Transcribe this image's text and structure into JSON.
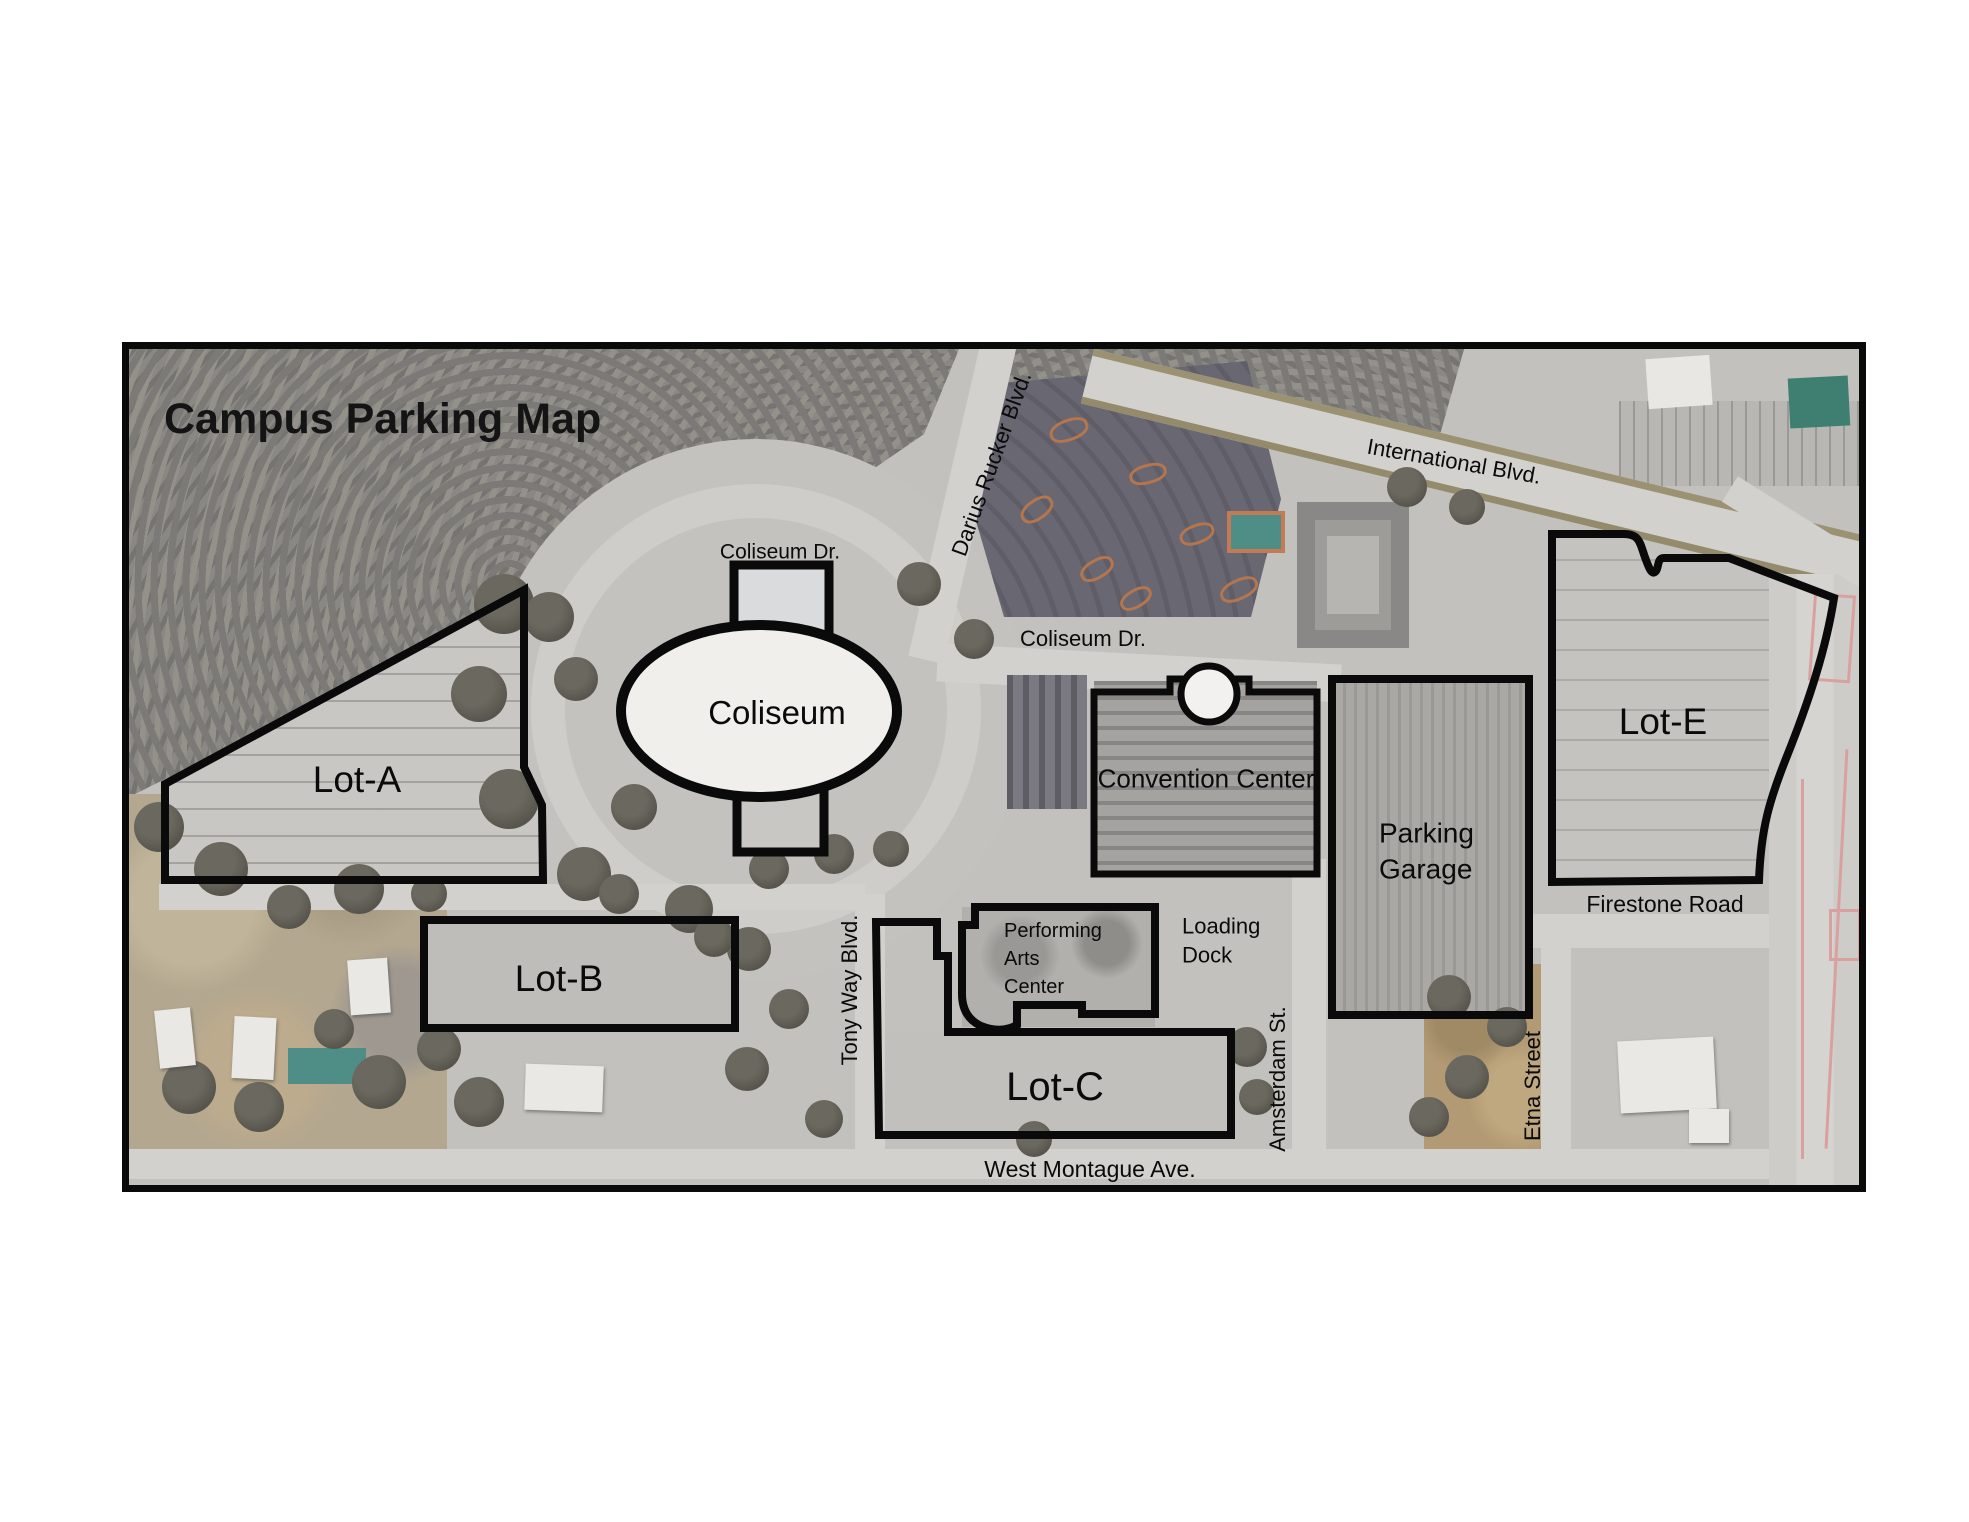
{
  "title": "Campus Parking Map",
  "streets": {
    "coliseum_dr_north": "Coliseum Dr.",
    "darius_rucker_blvd": "Darius Rucker Blvd.",
    "international_blvd": "International Blvd.",
    "coliseum_dr_east": "Coliseum Dr.",
    "tony_way_blvd": "Tony Way Blvd.",
    "amsterdam_st": "Amsterdam St.",
    "etna_street": "Etna Street",
    "firestone_road": "Firestone Road",
    "west_montague_ave": "West Montague Ave."
  },
  "parking_lots": {
    "lot_a": "Lot-A",
    "lot_b": "Lot-B",
    "lot_c": "Lot-C",
    "lot_e": "Lot-E"
  },
  "buildings": {
    "coliseum": "Coliseum",
    "convention_center": "Convention Center",
    "parking_garage": [
      "Parking",
      "Garage"
    ],
    "performing_arts_center": [
      "Performing",
      "Arts",
      "Center"
    ],
    "loading_dock": [
      "Loading",
      "Dock"
    ]
  },
  "colors": {
    "outline_black": "#0a0a0a",
    "pavement_gray": "#c6c4c0",
    "woods_gray": "#8a8884",
    "dark_parking_lot": "#696772",
    "road_light_gray": "#d3d1cd",
    "teal_roof": "#3f7f72",
    "pool_teal": "#4e8e86",
    "road_marking_pink": "#d9a0a0"
  }
}
